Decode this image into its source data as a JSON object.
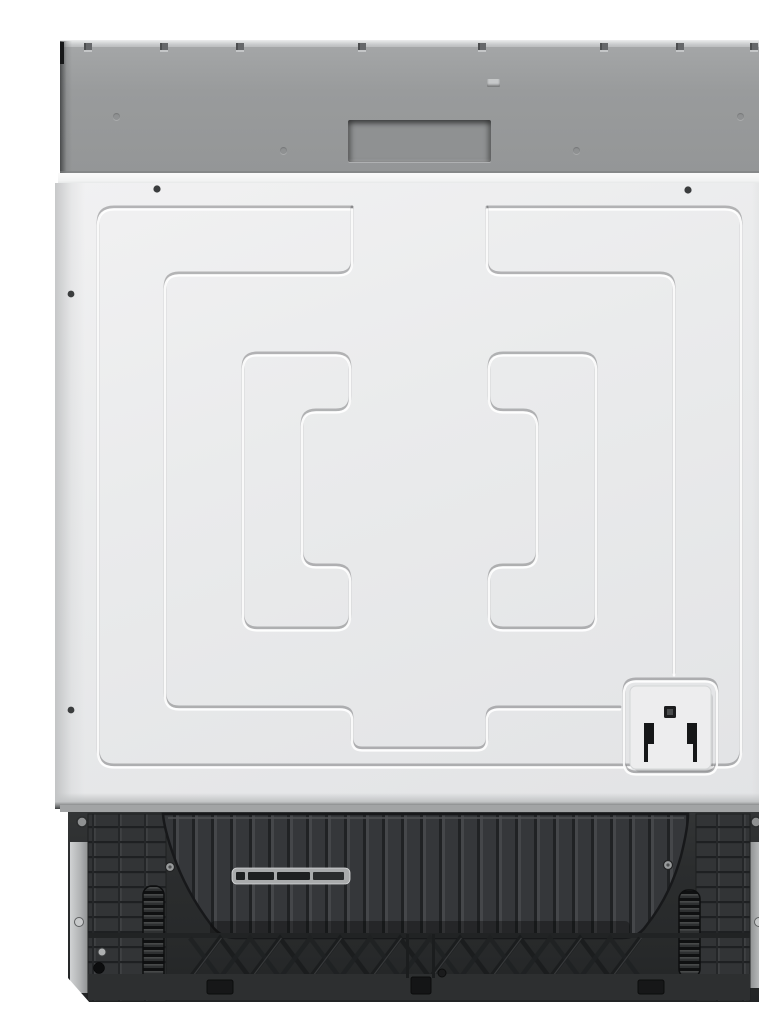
{
  "scene": {
    "type": "product-photo",
    "subject": "fully-integrated built-in dishwasher, front view, door closed",
    "aria_label": "Front view of a panel-ready built-in dishwasher: gray top control strip with recessed display cutout, plain white embossed door with pressed rectangular pattern and small rating plate, exposed black machine base with ribbed cover, vent slot, coil springs and mounting frame",
    "text_visible": false
  },
  "appliance": {
    "control_panel": {
      "color": "#9b9d9e",
      "display_window_color": "#8f9192",
      "clip_count": 8,
      "screw_dimple_count": 4,
      "small_vent_hole": true
    },
    "door": {
      "color": "#e9eaeb",
      "finish": "embossed pressed steel, concentric rectangular grooves with center channel",
      "visible_screw_count": 6,
      "rating_plate": {
        "color": "#ededee",
        "marks": [
          "small-black-square",
          "left-black-bracket-bar",
          "right-black-bracket-bar"
        ]
      }
    },
    "base": {
      "color": "#2b2d2e",
      "features": [
        "ribbed sump cover panel",
        "segmented vent slot",
        "left coil spring",
        "right coil spring",
        "diagonal truss ribs",
        "left side rail",
        "right side rail",
        "mounting bolts and screws"
      ]
    }
  },
  "palette": {
    "white": "#ffffff",
    "panel": "#9b9d9e",
    "display": "#8f9192",
    "rail": "#c9cbcc",
    "door": "#e9eaeb",
    "sill": "#f5f6f6",
    "base_sill": "#a2a4a5",
    "base": "#2b2d2e",
    "plate": "#ededee",
    "mark": "#161718",
    "strip": "#bfc1c2"
  }
}
